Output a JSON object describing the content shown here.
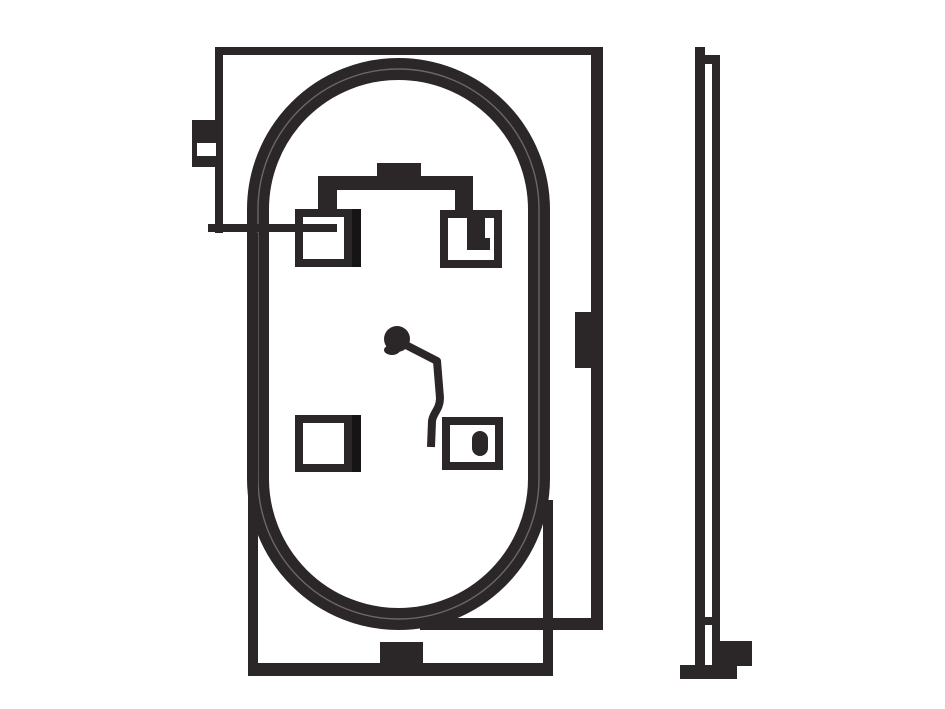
{
  "canvas": {
    "width": 945,
    "height": 709,
    "background": "#ffffff"
  },
  "colors": {
    "ink": "#2b2627",
    "ink_dark": "#171415",
    "paper": "#ffffff"
  },
  "drawing": {
    "groups": [
      {
        "name": "front-view",
        "shapes": [
          {
            "name": "oval-ring",
            "type": "stadium",
            "x": 258,
            "y": 69,
            "w": 281,
            "h": 550,
            "rx": 140.5,
            "stroke": 22,
            "color": "ink"
          },
          {
            "name": "oval-ring-highlight",
            "type": "stadium",
            "x": 258,
            "y": 69,
            "w": 281,
            "h": 550,
            "rx": 140.5,
            "stroke": 1.4,
            "color": "paper",
            "opacity": 0.3
          },
          {
            "name": "front-top-edge",
            "type": "rect",
            "x": 215,
            "y": 47,
            "w": 388,
            "h": 8,
            "color": "ink"
          },
          {
            "name": "front-left-edge",
            "type": "rect",
            "x": 215,
            "y": 47,
            "w": 8,
            "h": 186,
            "color": "ink"
          },
          {
            "name": "left-mount-tab",
            "type": "rect",
            "x": 192,
            "y": 120,
            "w": 27,
            "h": 47,
            "color": "ink"
          },
          {
            "name": "left-mount-tab-slot",
            "type": "rect",
            "x": 197,
            "y": 143,
            "w": 19,
            "h": 13,
            "color": "paper"
          },
          {
            "name": "left-lead-line",
            "type": "rect",
            "x": 208,
            "y": 224,
            "w": 129,
            "h": 8,
            "color": "ink"
          },
          {
            "name": "back-left-edge",
            "type": "rect",
            "x": 248,
            "y": 233,
            "w": 10,
            "h": 443,
            "color": "ink"
          },
          {
            "name": "back-bottom-edge",
            "type": "rect",
            "x": 248,
            "y": 663,
            "w": 305,
            "h": 13,
            "color": "ink"
          },
          {
            "name": "back-right-edge",
            "type": "rect",
            "x": 543,
            "y": 500,
            "w": 10,
            "h": 176,
            "color": "ink"
          },
          {
            "name": "front-right-edge",
            "type": "rect",
            "x": 591,
            "y": 47,
            "w": 12,
            "h": 583,
            "color": "ink"
          },
          {
            "name": "right-inner-tab",
            "type": "rect",
            "x": 575,
            "y": 312,
            "w": 16,
            "h": 56,
            "color": "ink"
          },
          {
            "name": "front-bottom-right-edge",
            "type": "rect",
            "x": 420,
            "y": 618,
            "w": 183,
            "h": 12,
            "color": "ink"
          },
          {
            "name": "bottom-center-bump",
            "type": "rect",
            "x": 380,
            "y": 642,
            "w": 43,
            "h": 21,
            "color": "ink"
          },
          {
            "name": "bracket-bar",
            "type": "rect",
            "x": 318,
            "y": 176,
            "w": 155,
            "h": 14,
            "color": "ink"
          },
          {
            "name": "bracket-left-drop",
            "type": "rect",
            "x": 318,
            "y": 190,
            "w": 19,
            "h": 22,
            "color": "ink"
          },
          {
            "name": "bracket-right-drop",
            "type": "rect",
            "x": 455,
            "y": 190,
            "w": 18,
            "h": 24,
            "color": "ink"
          },
          {
            "name": "bracket-top-bump",
            "type": "rect",
            "x": 377,
            "y": 163,
            "w": 44,
            "h": 13,
            "color": "ink"
          },
          {
            "name": "square-top-left",
            "type": "outline",
            "x": 295,
            "y": 209,
            "w": 57,
            "h": 58,
            "stroke": 8,
            "color": "ink"
          },
          {
            "name": "square-top-left-strip",
            "type": "rect",
            "x": 352,
            "y": 209,
            "w": 9,
            "h": 58,
            "color": "ink_dark"
          },
          {
            "name": "square-top-right",
            "type": "outline",
            "x": 440,
            "y": 210,
            "w": 62,
            "h": 58,
            "stroke": 8,
            "color": "ink"
          },
          {
            "name": "square-top-right-mark-a",
            "type": "rect",
            "x": 467,
            "y": 218,
            "w": 18,
            "h": 32,
            "color": "ink"
          },
          {
            "name": "square-top-right-mark-b",
            "type": "rect",
            "x": 467,
            "y": 238,
            "w": 23,
            "h": 12,
            "color": "ink"
          },
          {
            "name": "square-bottom-left",
            "type": "outline",
            "x": 295,
            "y": 415,
            "w": 57,
            "h": 57,
            "stroke": 8,
            "color": "ink"
          },
          {
            "name": "square-bottom-left-strip",
            "type": "rect",
            "x": 352,
            "y": 415,
            "w": 9,
            "h": 57,
            "color": "ink_dark"
          },
          {
            "name": "square-bottom-right",
            "type": "outline",
            "x": 442,
            "y": 417,
            "w": 61,
            "h": 53,
            "stroke": 8,
            "color": "ink"
          },
          {
            "name": "square-bottom-right-mark",
            "type": "rect",
            "x": 472,
            "y": 431,
            "w": 16,
            "h": 25,
            "rx": 8,
            "color": "ink"
          },
          {
            "name": "reference-blob",
            "type": "circle",
            "cx": 397,
            "cy": 339,
            "r": 13,
            "color": "ink"
          },
          {
            "name": "reference-blob-tail",
            "type": "ellipse",
            "cx": 392,
            "cy": 350,
            "rx": 8,
            "ry": 5,
            "color": "ink"
          },
          {
            "name": "reference-lead-path",
            "type": "path",
            "d": "M 402 343 L 437 361 L 440 398 C 440 409 433 413 432 421 L 431 447",
            "stroke": 8,
            "color": "ink"
          }
        ]
      },
      {
        "name": "side-view",
        "shapes": [
          {
            "name": "side-left-line",
            "type": "rect",
            "x": 695,
            "y": 47,
            "w": 10,
            "h": 618,
            "color": "ink"
          },
          {
            "name": "side-top-connector",
            "type": "rect",
            "x": 695,
            "y": 55,
            "w": 25,
            "h": 9,
            "color": "ink"
          },
          {
            "name": "side-right-line",
            "type": "rect",
            "x": 712,
            "y": 63,
            "w": 8,
            "h": 602,
            "color": "ink"
          },
          {
            "name": "side-crossbar",
            "type": "rect",
            "x": 695,
            "y": 617,
            "w": 23,
            "h": 8,
            "color": "ink"
          },
          {
            "name": "side-foot",
            "type": "rect",
            "x": 718,
            "y": 641,
            "w": 34,
            "h": 25,
            "color": "ink"
          },
          {
            "name": "side-base",
            "type": "rect",
            "x": 680,
            "y": 665,
            "w": 57,
            "h": 14,
            "color": "ink"
          }
        ]
      }
    ]
  }
}
